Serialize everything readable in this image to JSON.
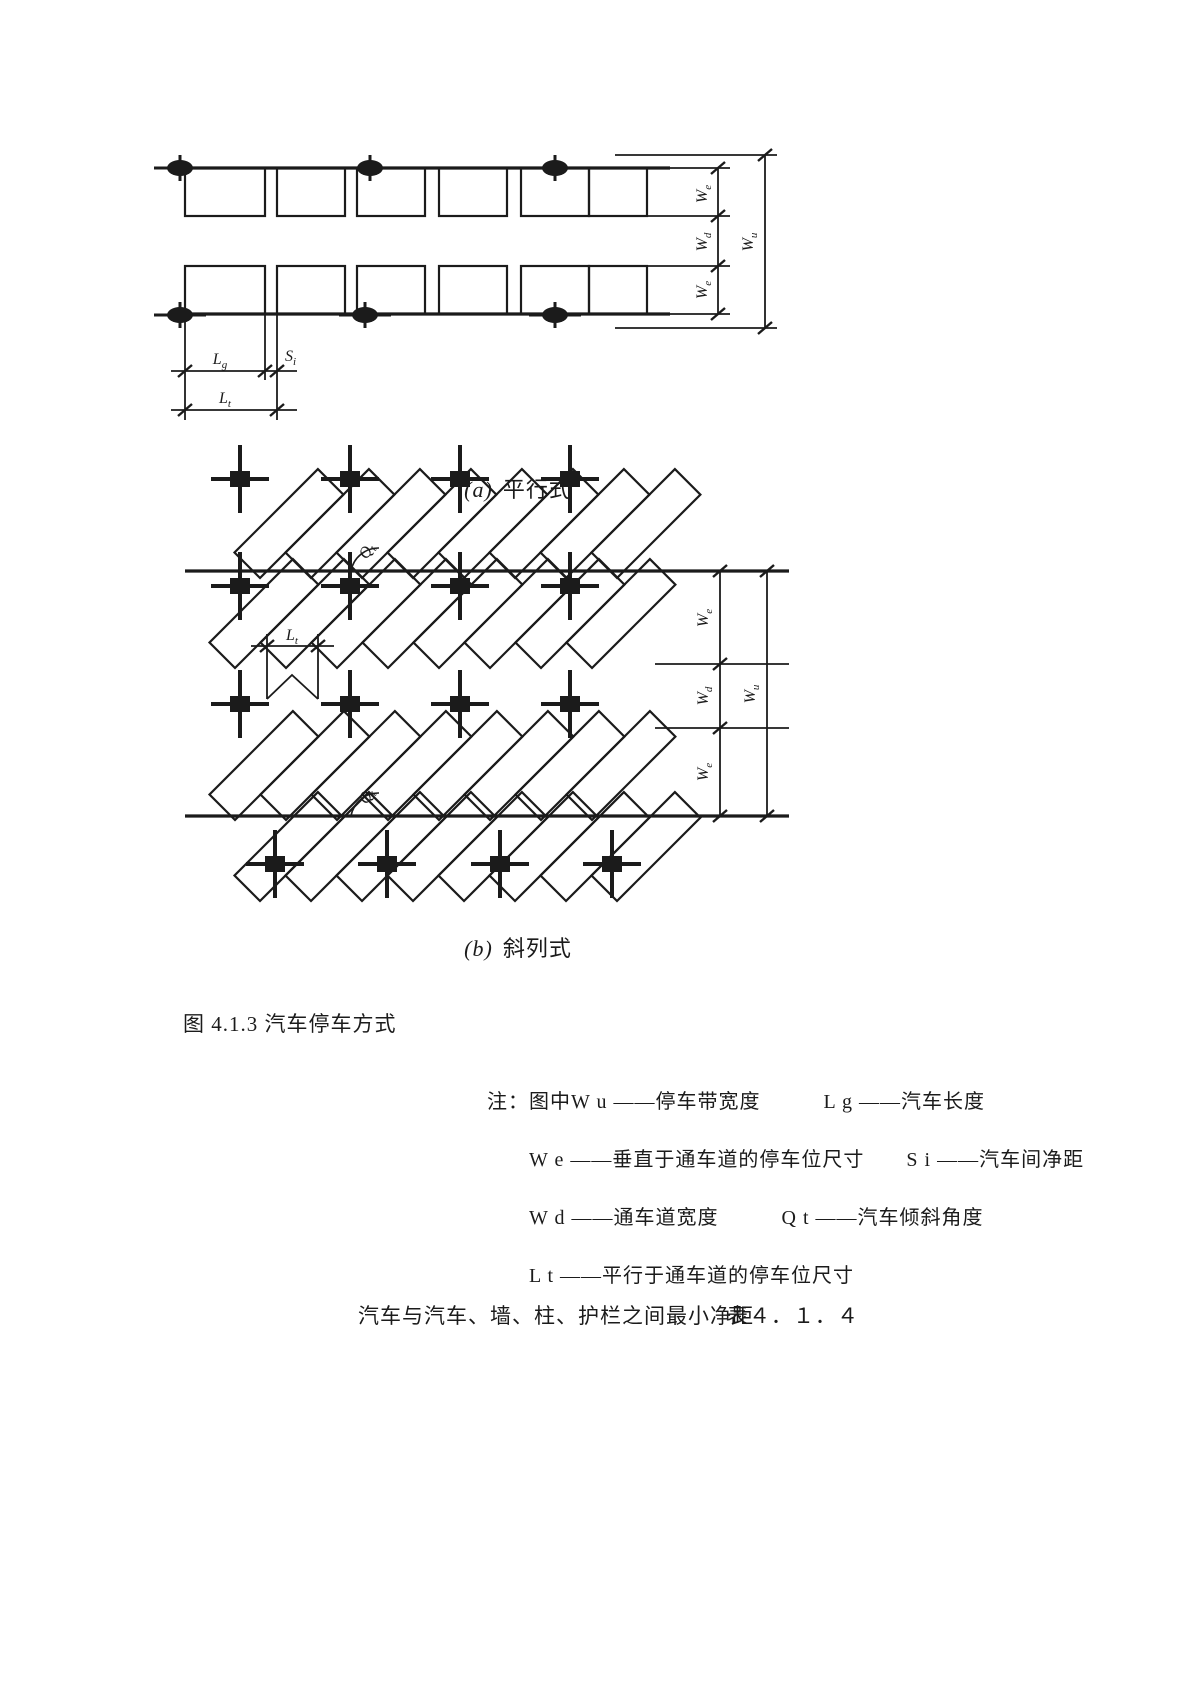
{
  "figure": {
    "caption_a_marker": "(a)",
    "caption_a_label": "平行式",
    "caption_b_marker": "(b)",
    "caption_b_label": "斜列式",
    "title": "图 4.1.3 汽车停车方式"
  },
  "dims": {
    "We": {
      "main": "W",
      "sub": "e"
    },
    "Wd": {
      "main": "W",
      "sub": "d"
    },
    "Wu": {
      "main": "W",
      "sub": "u"
    },
    "Lg": {
      "main": "L",
      "sub": "g"
    },
    "Lt": {
      "main": "L",
      "sub": "t"
    },
    "Si": {
      "main": "S",
      "sub": "i"
    },
    "Qt": {
      "main": "Q",
      "sub": "t"
    }
  },
  "notes": {
    "line1": "注：图中W u ——停车带宽度　　　L g ——汽车长度",
    "line2": "W e ——垂直于通车道的停车位尺寸　　S i ——汽车间净距",
    "line3": "W d ——通车道宽度　　　Q t ——汽车倾斜角度",
    "line4": "L t ——平行于通车道的停车位尺寸"
  },
  "table": {
    "title": "汽车与汽车、墙、柱、护栏之间最小净距",
    "number": "表４．１．４"
  },
  "colors": {
    "ink": "#1b1b1b",
    "paper": "#ffffff"
  }
}
